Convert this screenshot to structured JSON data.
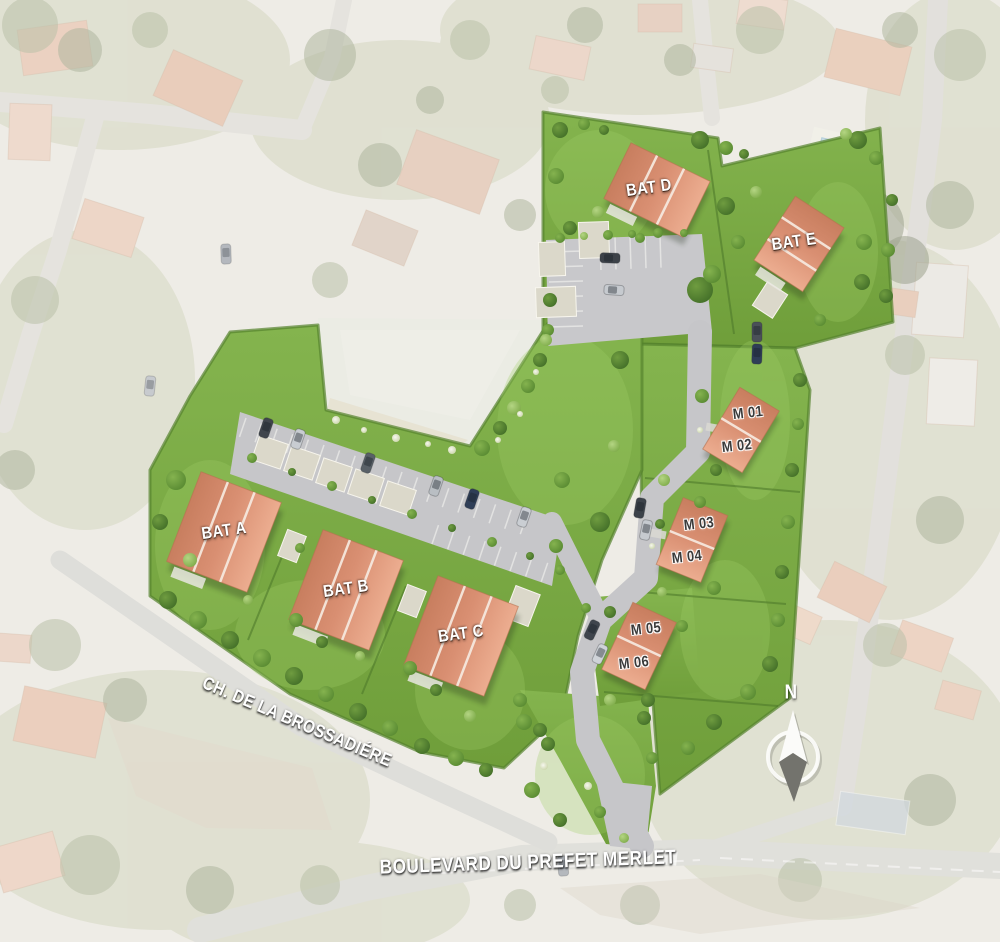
{
  "site_plan": {
    "buildings": [
      {
        "id": "bat-a",
        "label": "BAT A"
      },
      {
        "id": "bat-b",
        "label": "BAT B"
      },
      {
        "id": "bat-c",
        "label": "BAT C"
      },
      {
        "id": "bat-d",
        "label": "BAT D"
      },
      {
        "id": "bat-e",
        "label": "BAT E"
      }
    ],
    "maisons": [
      {
        "id": "m-01",
        "label": "M 01"
      },
      {
        "id": "m-02",
        "label": "M 02"
      },
      {
        "id": "m-03",
        "label": "M 03"
      },
      {
        "id": "m-04",
        "label": "M 04"
      },
      {
        "id": "m-05",
        "label": "M 05"
      },
      {
        "id": "m-06",
        "label": "M 06"
      }
    ],
    "streets": [
      {
        "id": "brossadiere",
        "label": "CH. DE LA BROSSADIÉRE"
      },
      {
        "id": "boulevard-prefet-merlet",
        "label": "BOULEVARD DU PREFET MERLET"
      }
    ],
    "compass": {
      "north_label": "N"
    },
    "colors": {
      "lawn": "#7aa944",
      "roof_terracotta": "#dd9478",
      "parking_gray": "#c7c7ca",
      "background_wash": "#ffffff",
      "label_light": "#ffffff",
      "label_dark": "#3a3a3a"
    }
  }
}
